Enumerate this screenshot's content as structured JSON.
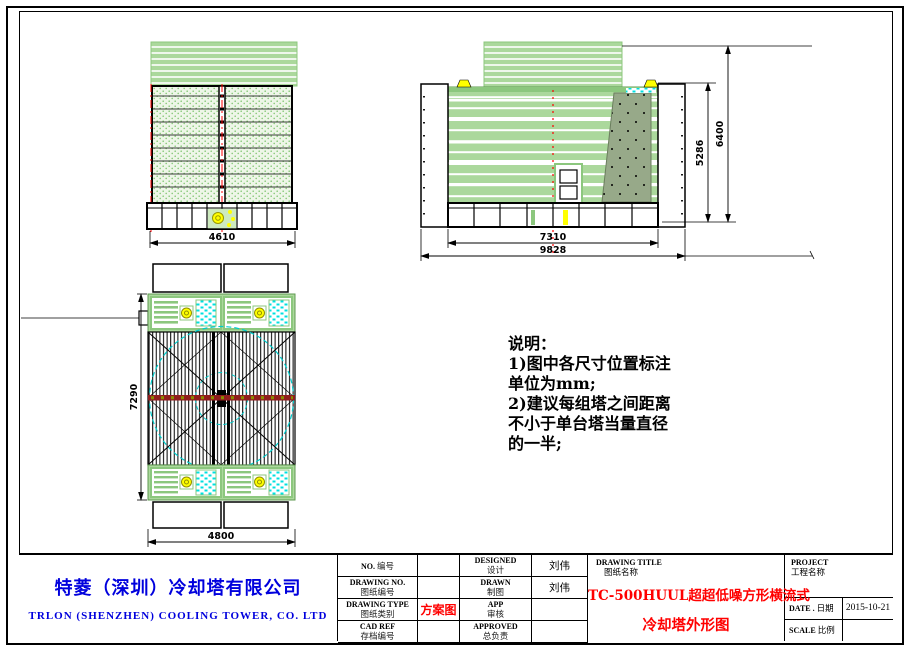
{
  "company": {
    "name_cn": "特菱（深圳）冷却塔有限公司",
    "name_en": "TRLON (SHENZHEN) COOLING TOWER, CO. LTD"
  },
  "notes": {
    "title": "说明：",
    "lines": [
      "1)图中各尺寸位置标注",
      "单位为mm;",
      "2)建议每组塔之间距离",
      "不小于单台塔当量直径",
      "的一半;"
    ]
  },
  "dims": {
    "front_width": "4610",
    "side_casing_width": "7310",
    "side_overall_width": "9828",
    "side_body_height": "5286",
    "side_overall_height": "6400",
    "plan_depth": "7290",
    "plan_width": "4800"
  },
  "titleblock": {
    "fields": {
      "no": {
        "en": "NO.",
        "cn": "编号",
        "value": ""
      },
      "drawing_no": {
        "en": "DRAWING NO.",
        "cn": "图纸编号",
        "value": ""
      },
      "drawing_type": {
        "en": "DRAWING TYPE",
        "cn": "图纸类别",
        "value": "方案图"
      },
      "cad_ref": {
        "en": "CAD REF",
        "cn": "存档编号",
        "value": ""
      },
      "designed": {
        "en": "DESIGNED",
        "cn": "设计",
        "value": "刘伟"
      },
      "drawn": {
        "en": "DRAWN",
        "cn": "制图",
        "value": "刘伟"
      },
      "app": {
        "en": "APP",
        "cn": "审核",
        "value": ""
      },
      "approved": {
        "en": "APPROVED",
        "cn": "总负责",
        "value": ""
      }
    },
    "drawing_title": {
      "en": "DRAWING TITLE",
      "cn": "图纸名称",
      "line1": "TC-500HUUL超超低噪方形横流式",
      "line2": "冷却塔外形图"
    },
    "project": {
      "en": "PROJECT",
      "cn": "工程名称",
      "value": ""
    },
    "date": {
      "en": "DATE .",
      "cn": "日期",
      "value": "2015-10-21"
    },
    "scale": {
      "en": "SCALE",
      "cn": "比例",
      "value": ""
    }
  },
  "colors": {
    "panel_green": "#abd89c",
    "stroke_green": "#7ab66b",
    "cyan": "#00e0e0",
    "yellow": "#ffff00",
    "centerline_red": "#ff0000",
    "beam_dark_red": "#8f1d1d",
    "company_blue": "#0000dd",
    "title_red": "#ff0000"
  }
}
